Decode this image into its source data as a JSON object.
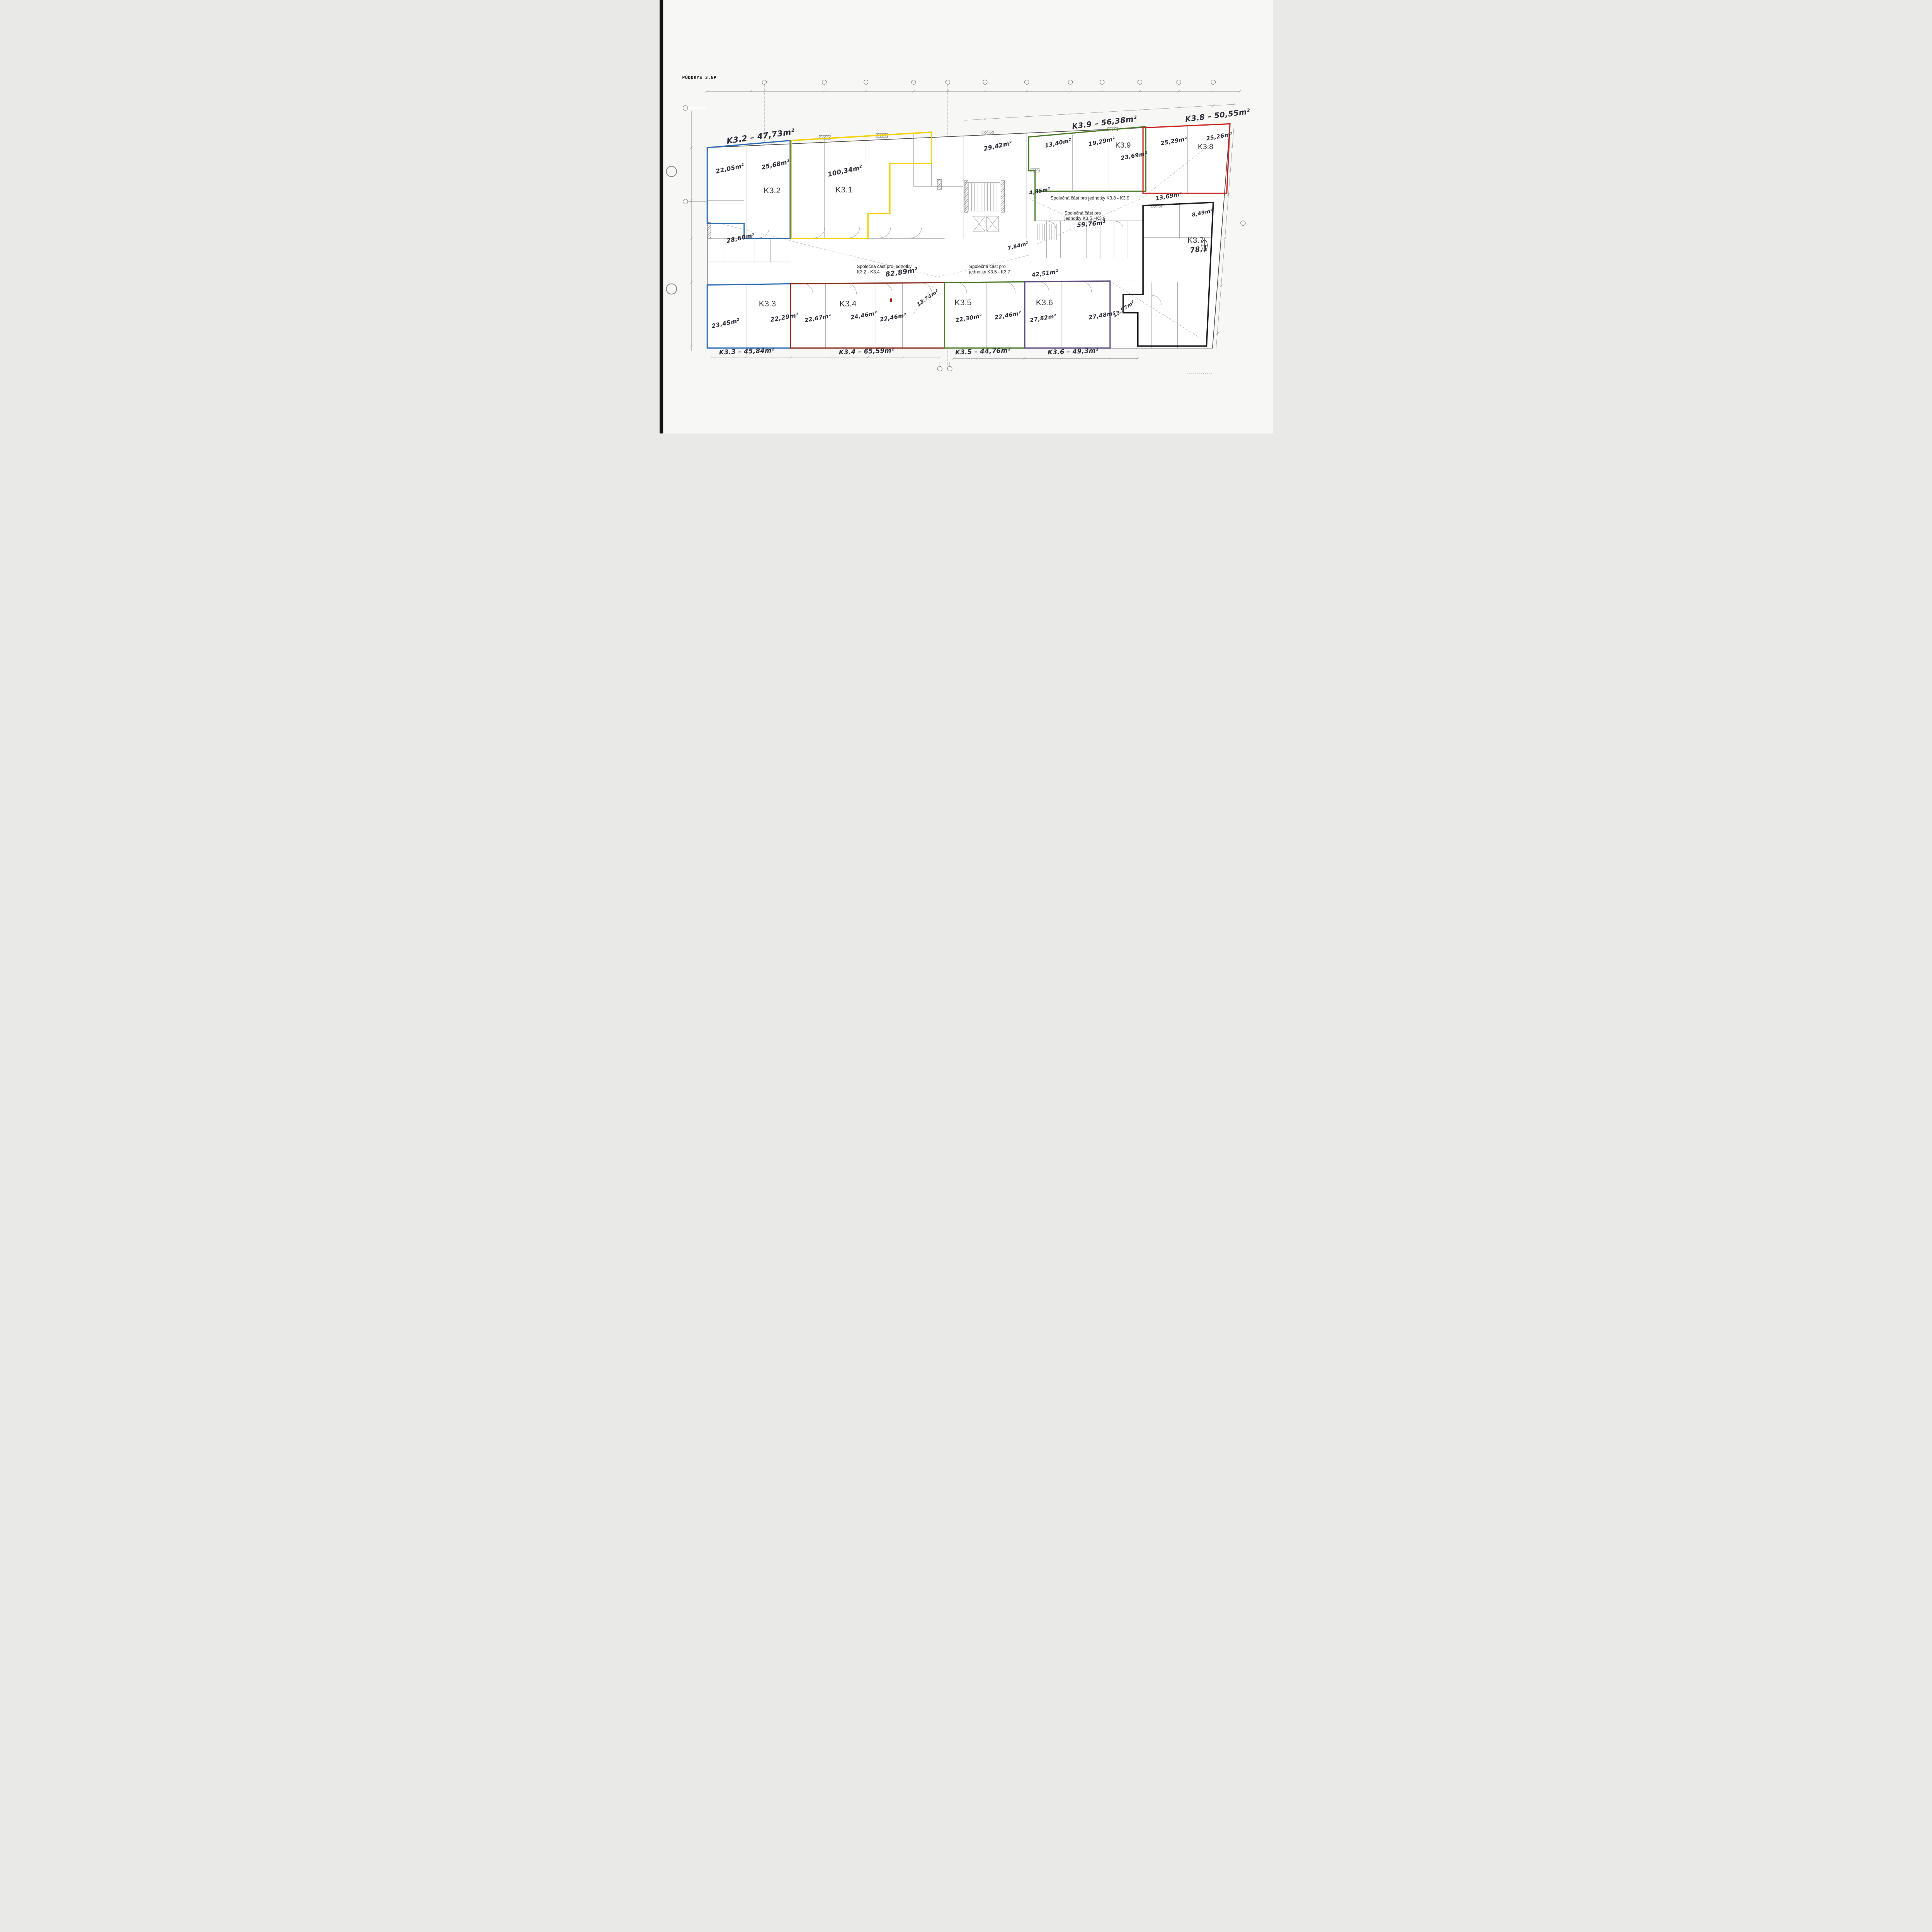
{
  "page": {
    "title": "PŮDORYS 3.NP"
  },
  "colors": {
    "blue": "#2e6db4",
    "yellow": "#f2d211",
    "green": "#4d7a2a",
    "red": "#c92323",
    "maroon": "#8a2e20",
    "purple": "#5a4a7a",
    "black": "#1d1d22",
    "outer_wall": "#4a4a4a",
    "handwriting": "#2a2a38",
    "marker_red": "#a31515"
  },
  "units": {
    "k31": {
      "label": "K3.1",
      "rooms": {
        "r1": "100,34m²"
      }
    },
    "k32": {
      "label": "K3.2",
      "total": "K3.2 – 47,73m²",
      "rooms": {
        "r1": "22,05m²",
        "r2": "25,68m²"
      }
    },
    "k33": {
      "label": "K3.3",
      "total": "K3.3 – 45,84m²",
      "rooms": {
        "r1": "23,45m²",
        "r2": "22,29m²"
      }
    },
    "k34": {
      "label": "K3.4",
      "total": "K3.4 – 65,59m²",
      "rooms": {
        "r1": "22,67m²",
        "r2": "24,46m²",
        "r3": "22,46m²"
      }
    },
    "k35": {
      "label": "K3.5",
      "total": "K3.5 – 44,76m²",
      "rooms": {
        "r1": "22,30m²",
        "r2": "22,46m²"
      }
    },
    "k36": {
      "label": "K3.6",
      "total": "K3.6 – 49,3m²",
      "rooms": {
        "r1": "27,82m²",
        "r2": "27,48m²"
      }
    },
    "k37": {
      "label": "K3.7",
      "area": "78,1"
    },
    "k38": {
      "label": "K3.8",
      "total": "K3.8 – 50,55m²",
      "rooms": {
        "r1": "25,29m²",
        "r2": "25,26m²"
      }
    },
    "k39": {
      "label": "K3.9",
      "total": "K3.9 – 56,38m²",
      "rooms": {
        "r1": "13,40m²",
        "r2": "19,29m²",
        "r3": "23,69m²"
      }
    }
  },
  "common_areas": {
    "k89": {
      "line1": "Společná část pro jednotky K3.8 - K3.9"
    },
    "k59": {
      "line1": "Společná část pro",
      "line2": "jednotky K3.5 - K3.9",
      "area": "59,76m²"
    },
    "k24": {
      "line1": "Společná část pro jednotky",
      "line2": "K3.2 - K3.4",
      "area": "82,89m²"
    },
    "k57": {
      "line1": "Společná část pro",
      "line2": "jednotky K3.5 - K3.7"
    }
  },
  "misc_areas": {
    "m2942": "29,42m²",
    "m485": "4,85m²",
    "m1369": "13,69m²",
    "m849": "8,49m²",
    "m2860": "28,60m²",
    "m784": "7,84m²",
    "m4251": "42,51m²",
    "m1374": "13,74m²",
    "m1397": "13,97m²"
  }
}
